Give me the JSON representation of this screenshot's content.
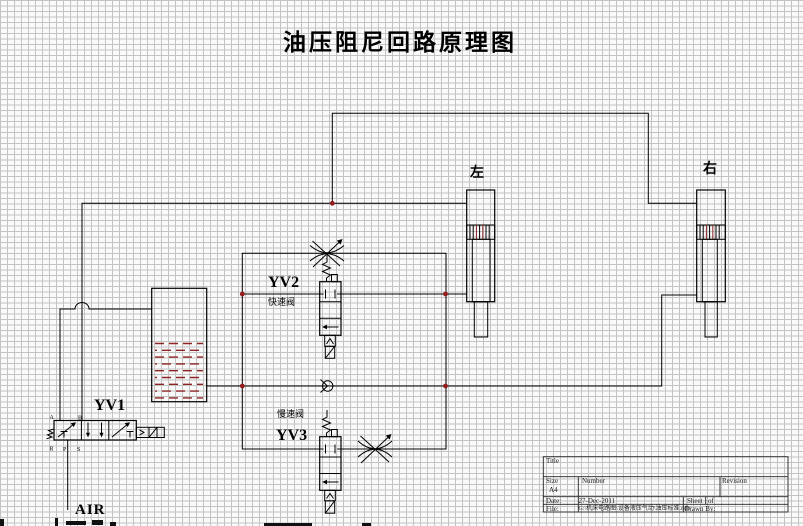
{
  "title": "油压阻尼回路原理图",
  "components": {
    "yv1": {
      "label": "YV1",
      "ports": {
        "a": "A",
        "b": "B",
        "r": "R",
        "p": "P",
        "s": "S"
      }
    },
    "yv2": {
      "label": "YV2",
      "caption": "快速阀"
    },
    "yv3": {
      "label": "YV3",
      "caption": "慢速阀"
    },
    "cylinder_left": {
      "label": "左"
    },
    "cylinder_right": {
      "label": "右"
    },
    "air_supply": {
      "label": "AIR"
    }
  },
  "title_block": {
    "title_label": "Title",
    "size_label": "Size",
    "size_value": "A4",
    "number_label": "Number",
    "revision_label": "Revision",
    "date_label": "Date:",
    "date_value": "27-Dec-2011",
    "sheet_label": "Sheet",
    "of_label": "of",
    "file_label": "File:",
    "file_value": "G:\\机床电路图\\设备液压气动\\油压标准.ddb",
    "drawn_by_label": "Drawn By:"
  },
  "colors": {
    "wire": "#000000",
    "junction_dot": "#941c1c",
    "tank_liquid": "#8e2323",
    "grid_line": "#c3c3c3",
    "canvas_bg": "#fafafa"
  }
}
